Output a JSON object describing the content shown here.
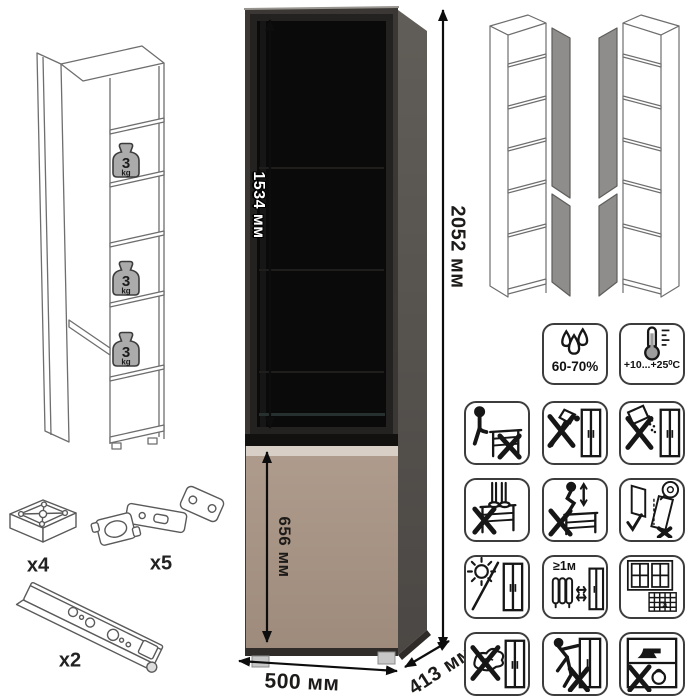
{
  "product": {
    "dimensions": {
      "glass_door_height": "1534 мм",
      "total_height": "2052 мм",
      "lower_door_height": "656 мм",
      "width": "500 мм",
      "depth": "413 мм"
    },
    "shelf_load": {
      "value": "3",
      "unit": "kg"
    }
  },
  "hardware": {
    "foot": {
      "label": "x4"
    },
    "hinge": {
      "label": "x5"
    },
    "rail": {
      "label": "x2"
    }
  },
  "climate": {
    "humidity": "60-70%",
    "temperature": "+10...+25⁰C"
  },
  "care": {
    "heater_distance": "≥1м",
    "calendar_day": "21",
    "icons": [
      "do-not-sit",
      "no-sharp-tools",
      "no-abrasive-cleaners",
      "do-not-stand",
      "do-not-jump",
      "door-adjustment",
      "avoid-direct-sunlight",
      "keep-1m-from-heater",
      "ventilate-room",
      "no-wet-cleaning",
      "do-not-drag",
      "no-heavy-objects"
    ]
  },
  "colors": {
    "cabinet_front": "#3a3734",
    "cabinet_side": "#585450",
    "glass": "#0a0a0a",
    "lower_door": "#a79585",
    "lower_door_highlight": "#d8cfc6"
  }
}
